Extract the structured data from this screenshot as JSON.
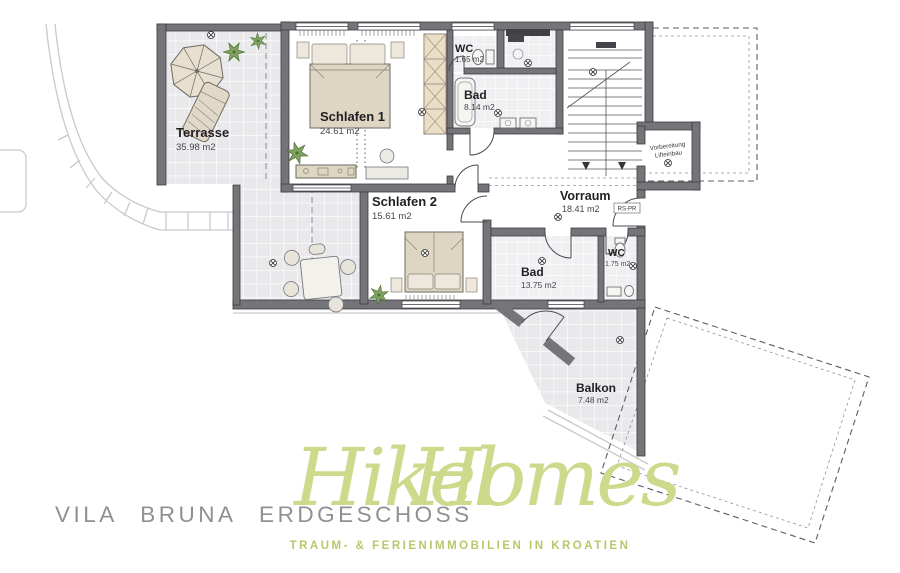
{
  "document": {
    "type": "architectural floor plan"
  },
  "rooms": {
    "terrasse": {
      "name": "Terrasse",
      "area": "35.98 m2"
    },
    "schlafen1": {
      "name": "Schlafen 1",
      "area": "24.61 m2"
    },
    "wc1": {
      "name": "WC",
      "area": "1.65 m2"
    },
    "bad1": {
      "name": "Bad",
      "area": "8.14 m2"
    },
    "schlafen2": {
      "name": "Schlafen 2",
      "area": "15.61 m2"
    },
    "vorraum": {
      "name": "Vorraum",
      "area": "18.41 m2"
    },
    "wc2": {
      "name": "WC",
      "area": "1.75 m2"
    },
    "bad2": {
      "name": "Bad",
      "area": "13.75 m2"
    },
    "balkon": {
      "name": "Balkon",
      "area": "7.48 m2"
    }
  },
  "annotations": {
    "lift_line1": "Vorbereitung",
    "lift_line2": "Lifteinbau",
    "riser_label": "RS-PR"
  },
  "footer": {
    "plan_title": "VILA  BRUNA  ERDGESCHOSS",
    "brand_word1": "Hikel",
    "brand_word2": "Homes",
    "tagline": "TRAUM- & FERIENIMMOBILIEN IN KROATIEN"
  },
  "colors": {
    "wall": "#747479",
    "tile": "#e9e9ec",
    "brand_green": "#cdd98b",
    "tagline_green": "#b9c76a",
    "title_gray": "#909094"
  }
}
